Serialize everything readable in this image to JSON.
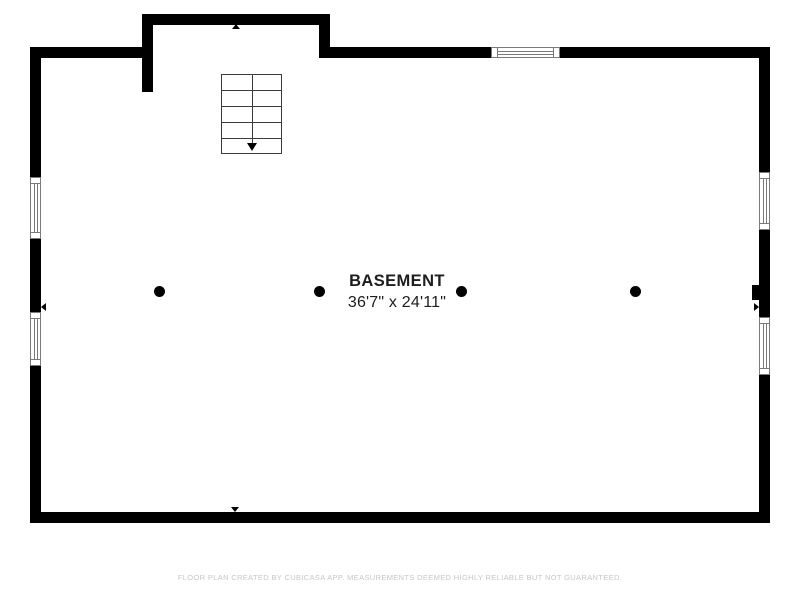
{
  "floorplan": {
    "room": {
      "name": "BASEMENT",
      "dimensions": "36'7\" x 24'11\""
    },
    "features": {
      "staircase": "stairs-leading-down-with-arrow",
      "column_count": 4,
      "window_count": 5,
      "wall_bump": "small-wall-projection-right-side"
    },
    "colors": {
      "wall": "#000000",
      "stair_outline": "#3c3c3c",
      "window_outline": "#7a7a7a",
      "label_text": "#1d1d1d",
      "footer_text": "#c6c6c6",
      "background": "#ffffff"
    }
  },
  "footer": {
    "disclaimer": "FLOOR PLAN CREATED BY CUBICASA APP. MEASUREMENTS DEEMED HIGHLY RELIABLE BUT NOT GUARANTEED."
  }
}
